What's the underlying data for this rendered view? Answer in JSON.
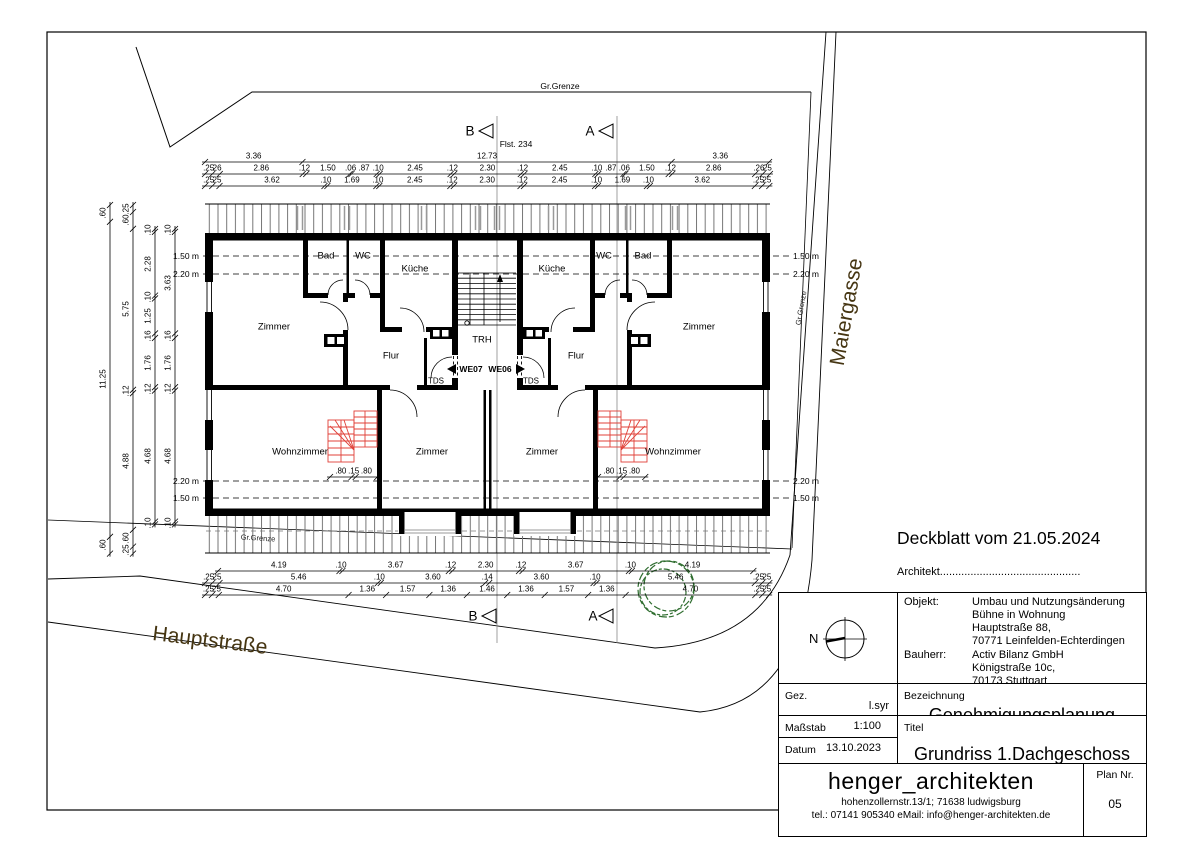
{
  "annotations": {
    "deckblatt": "Deckblatt vom 21.05.2024",
    "architekt": "Architekt.............................................."
  },
  "labels": {
    "rooms": [
      {
        "n": "room-bad-left",
        "t": "Bad",
        "x": 326,
        "y": 256,
        "c": "room"
      },
      {
        "n": "room-wc-left",
        "t": "WC",
        "x": 363,
        "y": 256,
        "c": "room"
      },
      {
        "n": "room-kueche-left",
        "t": "Küche",
        "x": 415,
        "y": 269,
        "c": "room"
      },
      {
        "n": "room-kueche-right",
        "t": "Küche",
        "x": 552,
        "y": 269,
        "c": "room"
      },
      {
        "n": "room-wc-right",
        "t": "WC",
        "x": 604,
        "y": 256,
        "c": "room"
      },
      {
        "n": "room-bad-right",
        "t": "Bad",
        "x": 643,
        "y": 256,
        "c": "room"
      },
      {
        "n": "room-zimmer-upper-left",
        "t": "Zimmer",
        "x": 274,
        "y": 327,
        "c": "room"
      },
      {
        "n": "room-zimmer-upper-right",
        "t": "Zimmer",
        "x": 699,
        "y": 327,
        "c": "room"
      },
      {
        "n": "room-flur-left",
        "t": "Flur",
        "x": 391,
        "y": 356,
        "c": "room"
      },
      {
        "n": "room-flur-right",
        "t": "Flur",
        "x": 576,
        "y": 356,
        "c": "room"
      },
      {
        "n": "room-trh",
        "t": "TRH",
        "x": 482,
        "y": 340,
        "c": "room"
      },
      {
        "n": "room-wohnzimmer-left",
        "t": "Wohnzimmer",
        "x": 300,
        "y": 452,
        "c": "room"
      },
      {
        "n": "room-zimmer-lower-left",
        "t": "Zimmer",
        "x": 432,
        "y": 452,
        "c": "room"
      },
      {
        "n": "room-zimmer-lower-right",
        "t": "Zimmer",
        "x": 542,
        "y": 452,
        "c": "room"
      },
      {
        "n": "room-wohnzimmer-right",
        "t": "Wohnzimmer",
        "x": 673,
        "y": 452,
        "c": "room"
      }
    ],
    "units": [
      {
        "n": "unit-we07",
        "t": "WE07",
        "x": 471,
        "y": 369,
        "c": "we"
      },
      {
        "n": "unit-we06",
        "t": "WE06",
        "x": 500,
        "y": 369,
        "c": "we"
      }
    ],
    "tds": [
      {
        "n": "tds-left",
        "t": "TDS",
        "x": 436,
        "y": 381,
        "c": "tds"
      },
      {
        "n": "tds-right",
        "t": "TDS",
        "x": 531,
        "y": 381,
        "c": "tds"
      }
    ],
    "heights": [
      {
        "n": "height-150-top-left",
        "t": "1.50 m",
        "x": 186,
        "y": 256,
        "c": "height"
      },
      {
        "n": "height-220-top-left",
        "t": "2.20 m",
        "x": 186,
        "y": 274,
        "c": "height"
      },
      {
        "n": "height-220-bottom-left",
        "t": "2.20 m",
        "x": 186,
        "y": 481,
        "c": "height"
      },
      {
        "n": "height-150-bottom-left",
        "t": "1.50 m",
        "x": 186,
        "y": 498,
        "c": "height"
      },
      {
        "n": "height-150-top-right",
        "t": "1.50 m",
        "x": 806,
        "y": 256,
        "c": "height"
      },
      {
        "n": "height-220-top-right",
        "t": "2.20 m",
        "x": 806,
        "y": 274,
        "c": "height"
      },
      {
        "n": "height-220-bottom-right",
        "t": "2.20 m",
        "x": 806,
        "y": 481,
        "c": "height"
      },
      {
        "n": "height-150-bottom-right",
        "t": "1.50 m",
        "x": 806,
        "y": 498,
        "c": "height"
      }
    ],
    "site": [
      {
        "n": "gr-grenze-top",
        "t": "Gr.Grenze",
        "x": 560,
        "y": 86,
        "c": "site-small"
      },
      {
        "n": "flst-234",
        "t": "Flst. 234",
        "x": 516,
        "y": 144,
        "c": "site-small"
      },
      {
        "n": "gr-grenze-right",
        "t": "Gr.Grenze",
        "x": 801,
        "y": 308,
        "c": "site-tiny",
        "r": -80
      },
      {
        "n": "gr-grenze-bottom",
        "t": "Gr.Grenze",
        "x": 258,
        "y": 538,
        "c": "site-tiny",
        "r": 3.5
      }
    ],
    "streets": [
      {
        "n": "street-maiergasse",
        "t": "Maiergasse",
        "x": 847,
        "y": 312,
        "c": "street",
        "r": -80
      },
      {
        "n": "street-hauptstrasse",
        "t": "Hauptstraße",
        "x": 210,
        "y": 641,
        "c": "street",
        "r": 7
      }
    ],
    "sections": [
      {
        "n": "section-b-top",
        "t": "B",
        "x": 470,
        "y": 131,
        "c": "section"
      },
      {
        "n": "section-a-top",
        "t": "A",
        "x": 590,
        "y": 131,
        "c": "section"
      },
      {
        "n": "section-b-bottom",
        "t": "B",
        "x": 473,
        "y": 616,
        "c": "section"
      },
      {
        "n": "section-a-bottom",
        "t": "A",
        "x": 593,
        "y": 616,
        "c": "section"
      }
    ]
  },
  "dimensions": {
    "chains": [
      {
        "id": "top-a",
        "dir": "h",
        "x": 205,
        "y": 162,
        "s": 29,
        "values": [
          "3.36",
          "12.73",
          "3.36"
        ]
      },
      {
        "id": "top-b",
        "dir": "h",
        "x": 205,
        "y": 174,
        "s": 29,
        "values": [
          ".25",
          ".26",
          "2.86",
          ".12",
          "1.50",
          ".06",
          ".87",
          ".10",
          "2.45",
          ".12",
          "2.30",
          ".12",
          "2.45",
          ".10",
          ".87",
          ".06",
          "1.50",
          ".12",
          "2.86",
          ".26",
          ".25"
        ]
      },
      {
        "id": "top-c",
        "dir": "h",
        "x": 205,
        "y": 186,
        "s": 29,
        "values": [
          ".25",
          ".25",
          "3.62",
          ".10",
          "1.69",
          ".10",
          "2.45",
          ".12",
          "2.30",
          ".12",
          "2.45",
          ".10",
          "1.69",
          ".10",
          "3.62",
          ".25",
          ".25"
        ]
      },
      {
        "id": "bottom-a",
        "dir": "h",
        "x": 218,
        "y": 571,
        "s": 29,
        "values": [
          "4.19",
          ".10",
          "3.67",
          ".12",
          "2.30",
          ".12",
          "3.67",
          ".10",
          "4.19"
        ]
      },
      {
        "id": "bottom-b",
        "dir": "h",
        "x": 205,
        "y": 583,
        "s": 29,
        "values": [
          ".25",
          ".25",
          "5.46",
          ".10",
          "3.60",
          ".14",
          "3.60",
          ".10",
          "5.46",
          ".25",
          ".25"
        ]
      },
      {
        "id": "bottom-c",
        "dir": "h",
        "x": 205,
        "y": 595,
        "s": 27.6,
        "values": [
          ".25",
          ".25",
          "4.70",
          "1.36",
          "1.57",
          "1.36",
          "1.46",
          "1.36",
          "1.57",
          "1.36",
          "4.70",
          ".25",
          ".25"
        ]
      },
      {
        "id": "left-outer",
        "dir": "v",
        "x": 110,
        "y": 205,
        "s": 28,
        "values": [
          ".60",
          "11.25",
          ".60"
        ]
      },
      {
        "id": "left-mid",
        "dir": "v",
        "x": 133,
        "y": 205,
        "s": 28,
        "values": [
          ".25",
          ".60",
          "5.75",
          ".12",
          "4.88",
          ".60",
          ".25"
        ]
      },
      {
        "id": "left-inner1",
        "dir": "v",
        "x": 155,
        "y": 229,
        "s": 28,
        "values": [
          ".10",
          "2.28",
          ".10",
          "1.25",
          ".16",
          "1.76",
          ".12",
          "4.68",
          ".10"
        ]
      },
      {
        "id": "left-inner2",
        "dir": "v",
        "x": 175,
        "y": 229,
        "s": 28,
        "values": [
          ".10",
          "3.63",
          ".16",
          "1.76",
          ".12",
          "4.68",
          ".10"
        ]
      },
      {
        "id": "exit-left",
        "dir": "h",
        "x": 330,
        "y": 477,
        "s": 27,
        "values": [
          ".80",
          ".15",
          ".80"
        ]
      },
      {
        "id": "exit-right",
        "dir": "h",
        "x": 598,
        "y": 477,
        "s": 27,
        "values": [
          ".80",
          ".15",
          ".80"
        ]
      }
    ]
  },
  "title_block": {
    "north_label": "N",
    "objekt_label": "Objekt:",
    "objekt_lines": [
      "Umbau und Nutzungsänderung",
      "Bühne in Wohnung",
      "Hauptstraße 88,",
      "70771 Leinfelden-Echterdingen"
    ],
    "bauherr_label": "Bauherr:",
    "bauherr_lines": [
      "Activ Bilanz GmbH",
      "Königstraße 10c,",
      "70173 Stuttgart"
    ],
    "gez_label": "Gez.",
    "gez_value": "l.syr",
    "bezeichnung_label": "Bezeichnung",
    "bezeichnung_value": "Genehmigungsplanung",
    "massstab_label": "Maßstab",
    "massstab_value": "1:100",
    "datum_label": "Datum",
    "datum_value": "13.10.2023",
    "titel_label": "Titel",
    "titel_value": "Grundriss 1.Dachgeschoss",
    "firm_name": "henger_architekten",
    "firm_address": "hohenzollernstr.13/1; 71638 ludwigsburg",
    "firm_contact": "tel.: 07141 905340   eMail: info@henger-architekten.de",
    "plan_nr_label": "Plan Nr.",
    "plan_nr_value": "05"
  }
}
